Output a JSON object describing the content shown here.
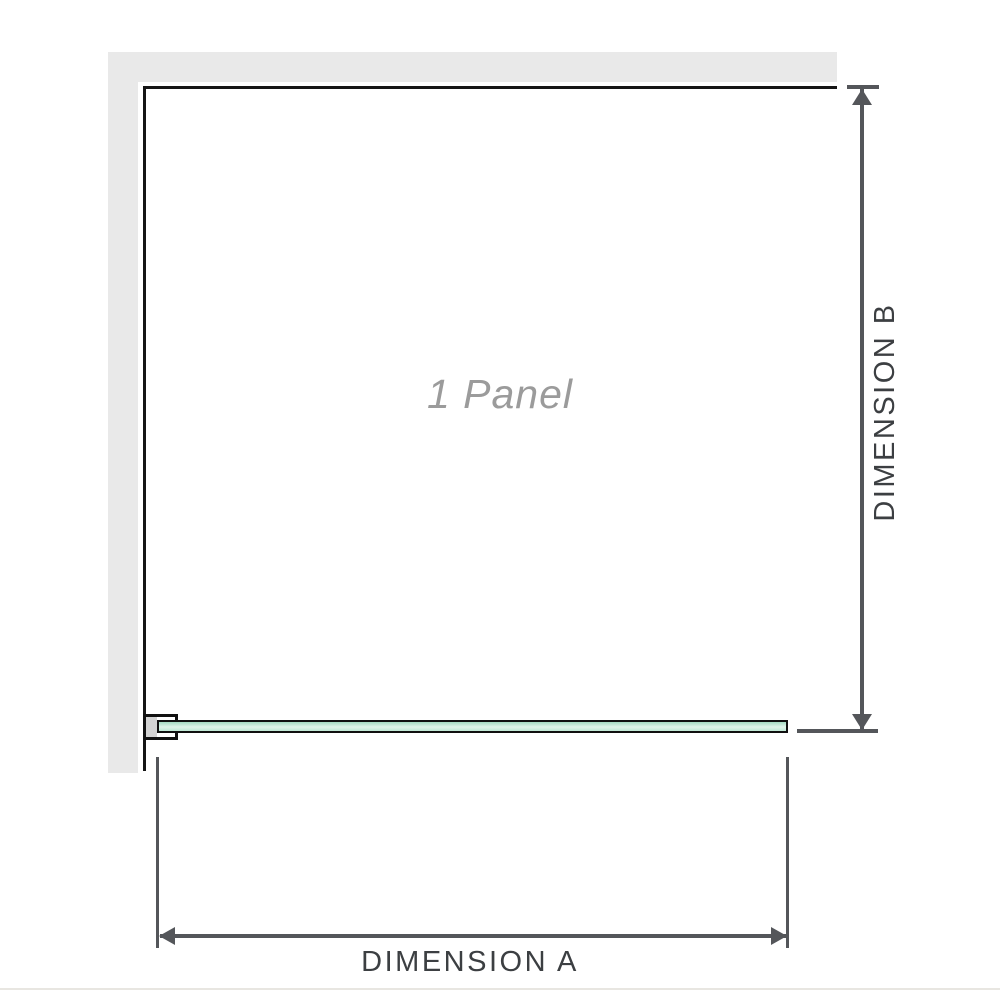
{
  "diagram": {
    "panel_label": "1 Panel",
    "dimension_a_label": "DIMENSION A",
    "dimension_b_label": "DIMENSION B",
    "colors": {
      "wall": "#e9e9e9",
      "frame_outline": "#151515",
      "glass_green_top": "#a4dac2",
      "glass_green_mid": "#e0f4ea",
      "glass_green_bottom": "#bfe8d5",
      "dimension_line": "#54565a",
      "dimension_text": "#3c3f42",
      "panel_label_text": "#9b9b9b",
      "bracket_fill": "#d3d3d3",
      "footer_rule": "#e8e6e1"
    }
  }
}
